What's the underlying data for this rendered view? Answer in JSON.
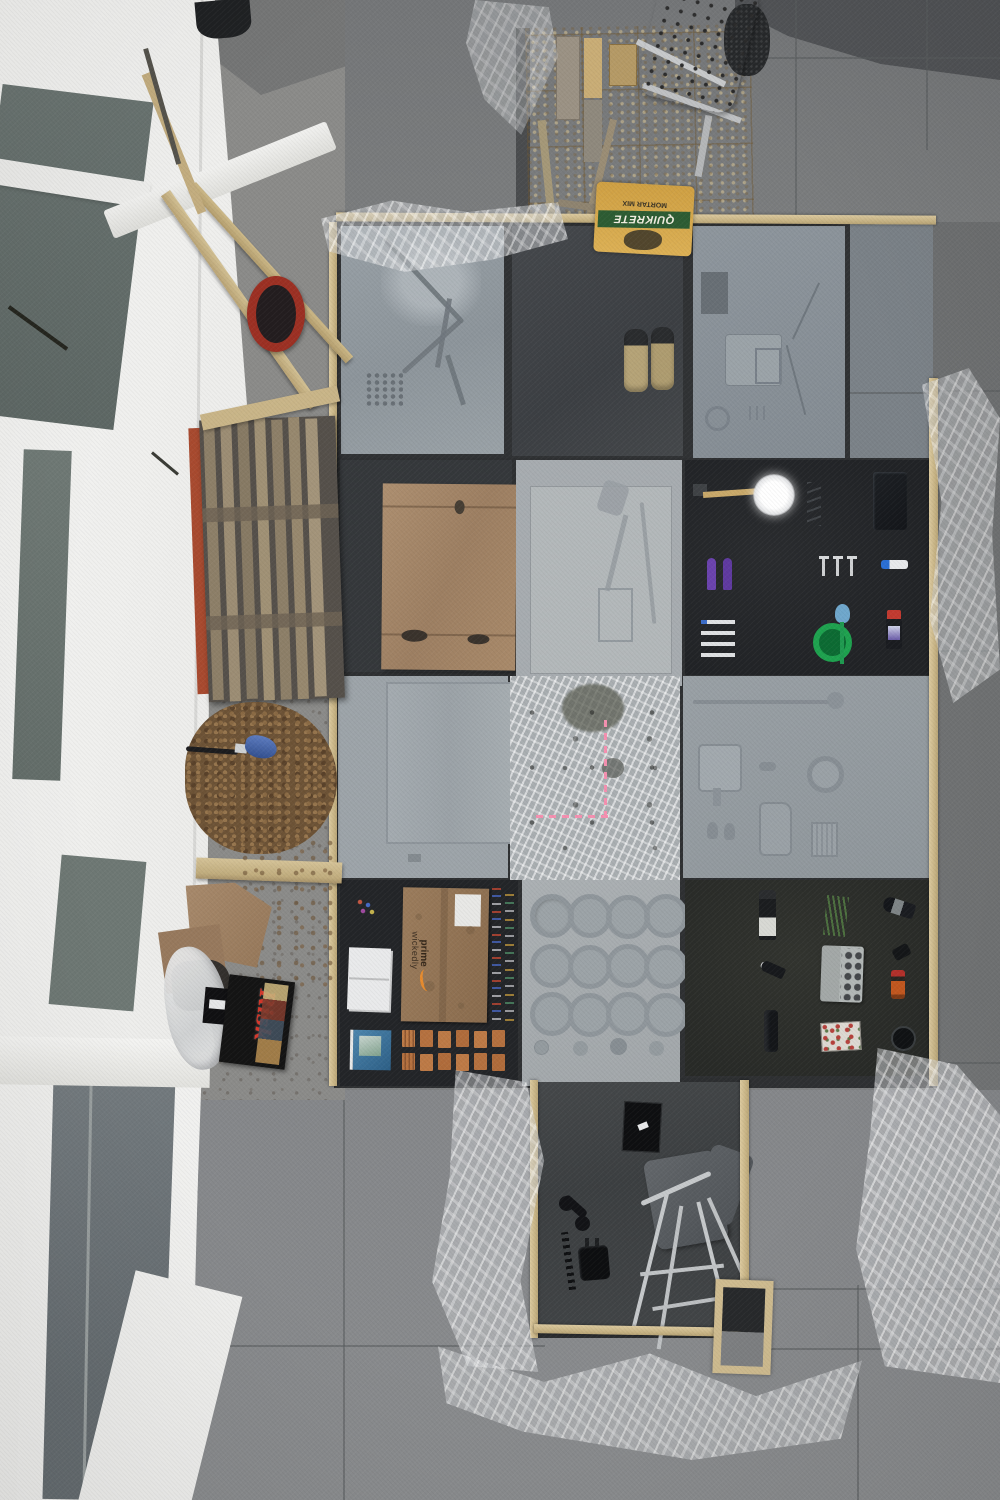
{
  "scene": {
    "type": "overhead-photo",
    "subject": "concrete slab casting project on patio with objects pressed into wet concrete",
    "labels": {
      "quikrete_brand": "QUIKRETE",
      "quikrete_product": "MORTAR MIX",
      "risk_title": "Risk",
      "amazon_line1": "wickedly",
      "amazon_line2": "prime"
    },
    "colors": {
      "patio_tile": "#7e8081",
      "patio_tile_dark": "#6f7172",
      "wet_concrete": "#515356",
      "slab_light": "#9aa1a6",
      "slab_mid": "#8e969d",
      "slab_dark": "#3a3d40",
      "slab_black": "#232527",
      "wood_rail": "#d0bd92",
      "osb_board": "#bb9c63",
      "cardboard": "#a5896b",
      "quikrete_yellow": "#d9ab4c",
      "quikrete_green": "#2d5c33",
      "risk_red": "#d4372b",
      "copper_pennies": "#b5713f",
      "bucket_red": "#9c3023",
      "facade_white": "#f3f3f1",
      "window_glass": "#6d7673",
      "plastic_sheet": "#d5d8da",
      "mulch_brown": "#6d5336",
      "bowl_green": "#1ea24f",
      "trowel_purple": "#6b43ae",
      "brush_blue": "#3c59a8",
      "pink_chalk": "#f590b0"
    },
    "objects": [
      "white-perforated-chair",
      "osb-plywood-board",
      "quikrete-bag",
      "leaning-lumber-boards",
      "red-bucket",
      "wood-pallet",
      "mulch-pile",
      "blue-scrub-brush",
      "two-by-four-plank",
      "cardboard-scraps",
      "risk-game-box",
      "white-plastic-bag",
      "slab-grid",
      "bike-frame-imprint-slab",
      "sneakers-on-slab",
      "object-imprint-slab",
      "cardboard-covered-slab",
      "tool-imprint-slab",
      "cleaning-items-slab",
      "panel-imprint-slab",
      "plastic-textured-slab-with-pink-chalk",
      "household-imprint-slab",
      "amazon-box-slab",
      "penny-stacks",
      "muffin-ring-slab",
      "bottles-and-egg-carton-slab",
      "telephone-handset",
      "power-adapter",
      "picture-frame",
      "metal-frame-chair",
      "small-wood-form",
      "plastic-sheeting",
      "building-facade",
      "windows",
      "patio-tiles"
    ]
  }
}
